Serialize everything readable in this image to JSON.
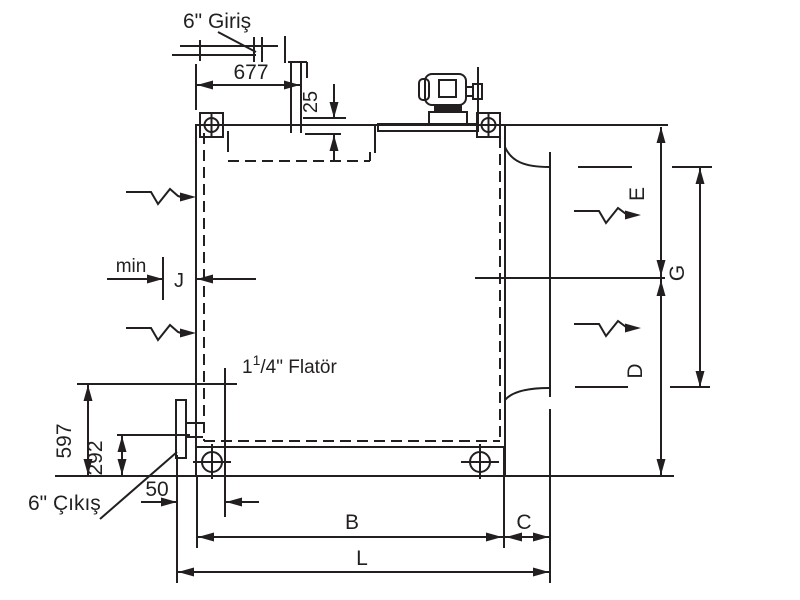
{
  "drawing": {
    "title_hint": "Hydraulic tank dimensional drawing",
    "colors": {
      "line": "#231f20",
      "background": "#ffffff"
    },
    "labels": {
      "inlet": "6\" Giriş",
      "outlet": "6\" Çıkış",
      "min": "min",
      "float_prefix": "1",
      "float_sup": "1",
      "float_suffix": "/4\" Flatör"
    },
    "dims": {
      "d677": "677",
      "d25": "25",
      "d597": "597",
      "d292": "292",
      "d50": "50",
      "b": "B",
      "c": "C",
      "l": "L",
      "e": "E",
      "g": "G",
      "d": "D",
      "j": "J"
    }
  }
}
